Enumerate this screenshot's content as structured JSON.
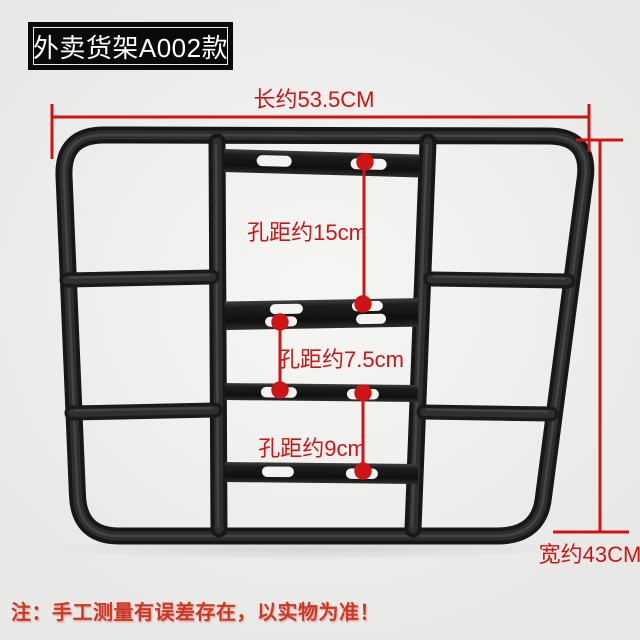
{
  "image": {
    "type": "product-dimension-diagram",
    "background_color": "#efefed"
  },
  "badge": {
    "label": "外卖货架A002款",
    "bg_color": "#0a0a0a",
    "text_color": "#ffffff"
  },
  "dimensions": {
    "accent_color": "#ce1515",
    "length": {
      "label": "长约53.5CM",
      "value_cm": 53.5
    },
    "width": {
      "label": "宽约43CM",
      "value_cm": 43
    },
    "hole_spacings": [
      {
        "label": "孔距约15cm",
        "value_cm": 15
      },
      {
        "label": "孔距约7.5cm",
        "value_cm": 7.5
      },
      {
        "label": "孔距约9cm",
        "value_cm": 9
      }
    ]
  },
  "note": {
    "label": "注：手工测量有误差存在，以实物为准！",
    "color": "#cc3726"
  },
  "product": {
    "frame_color": "#1a1a1a"
  }
}
